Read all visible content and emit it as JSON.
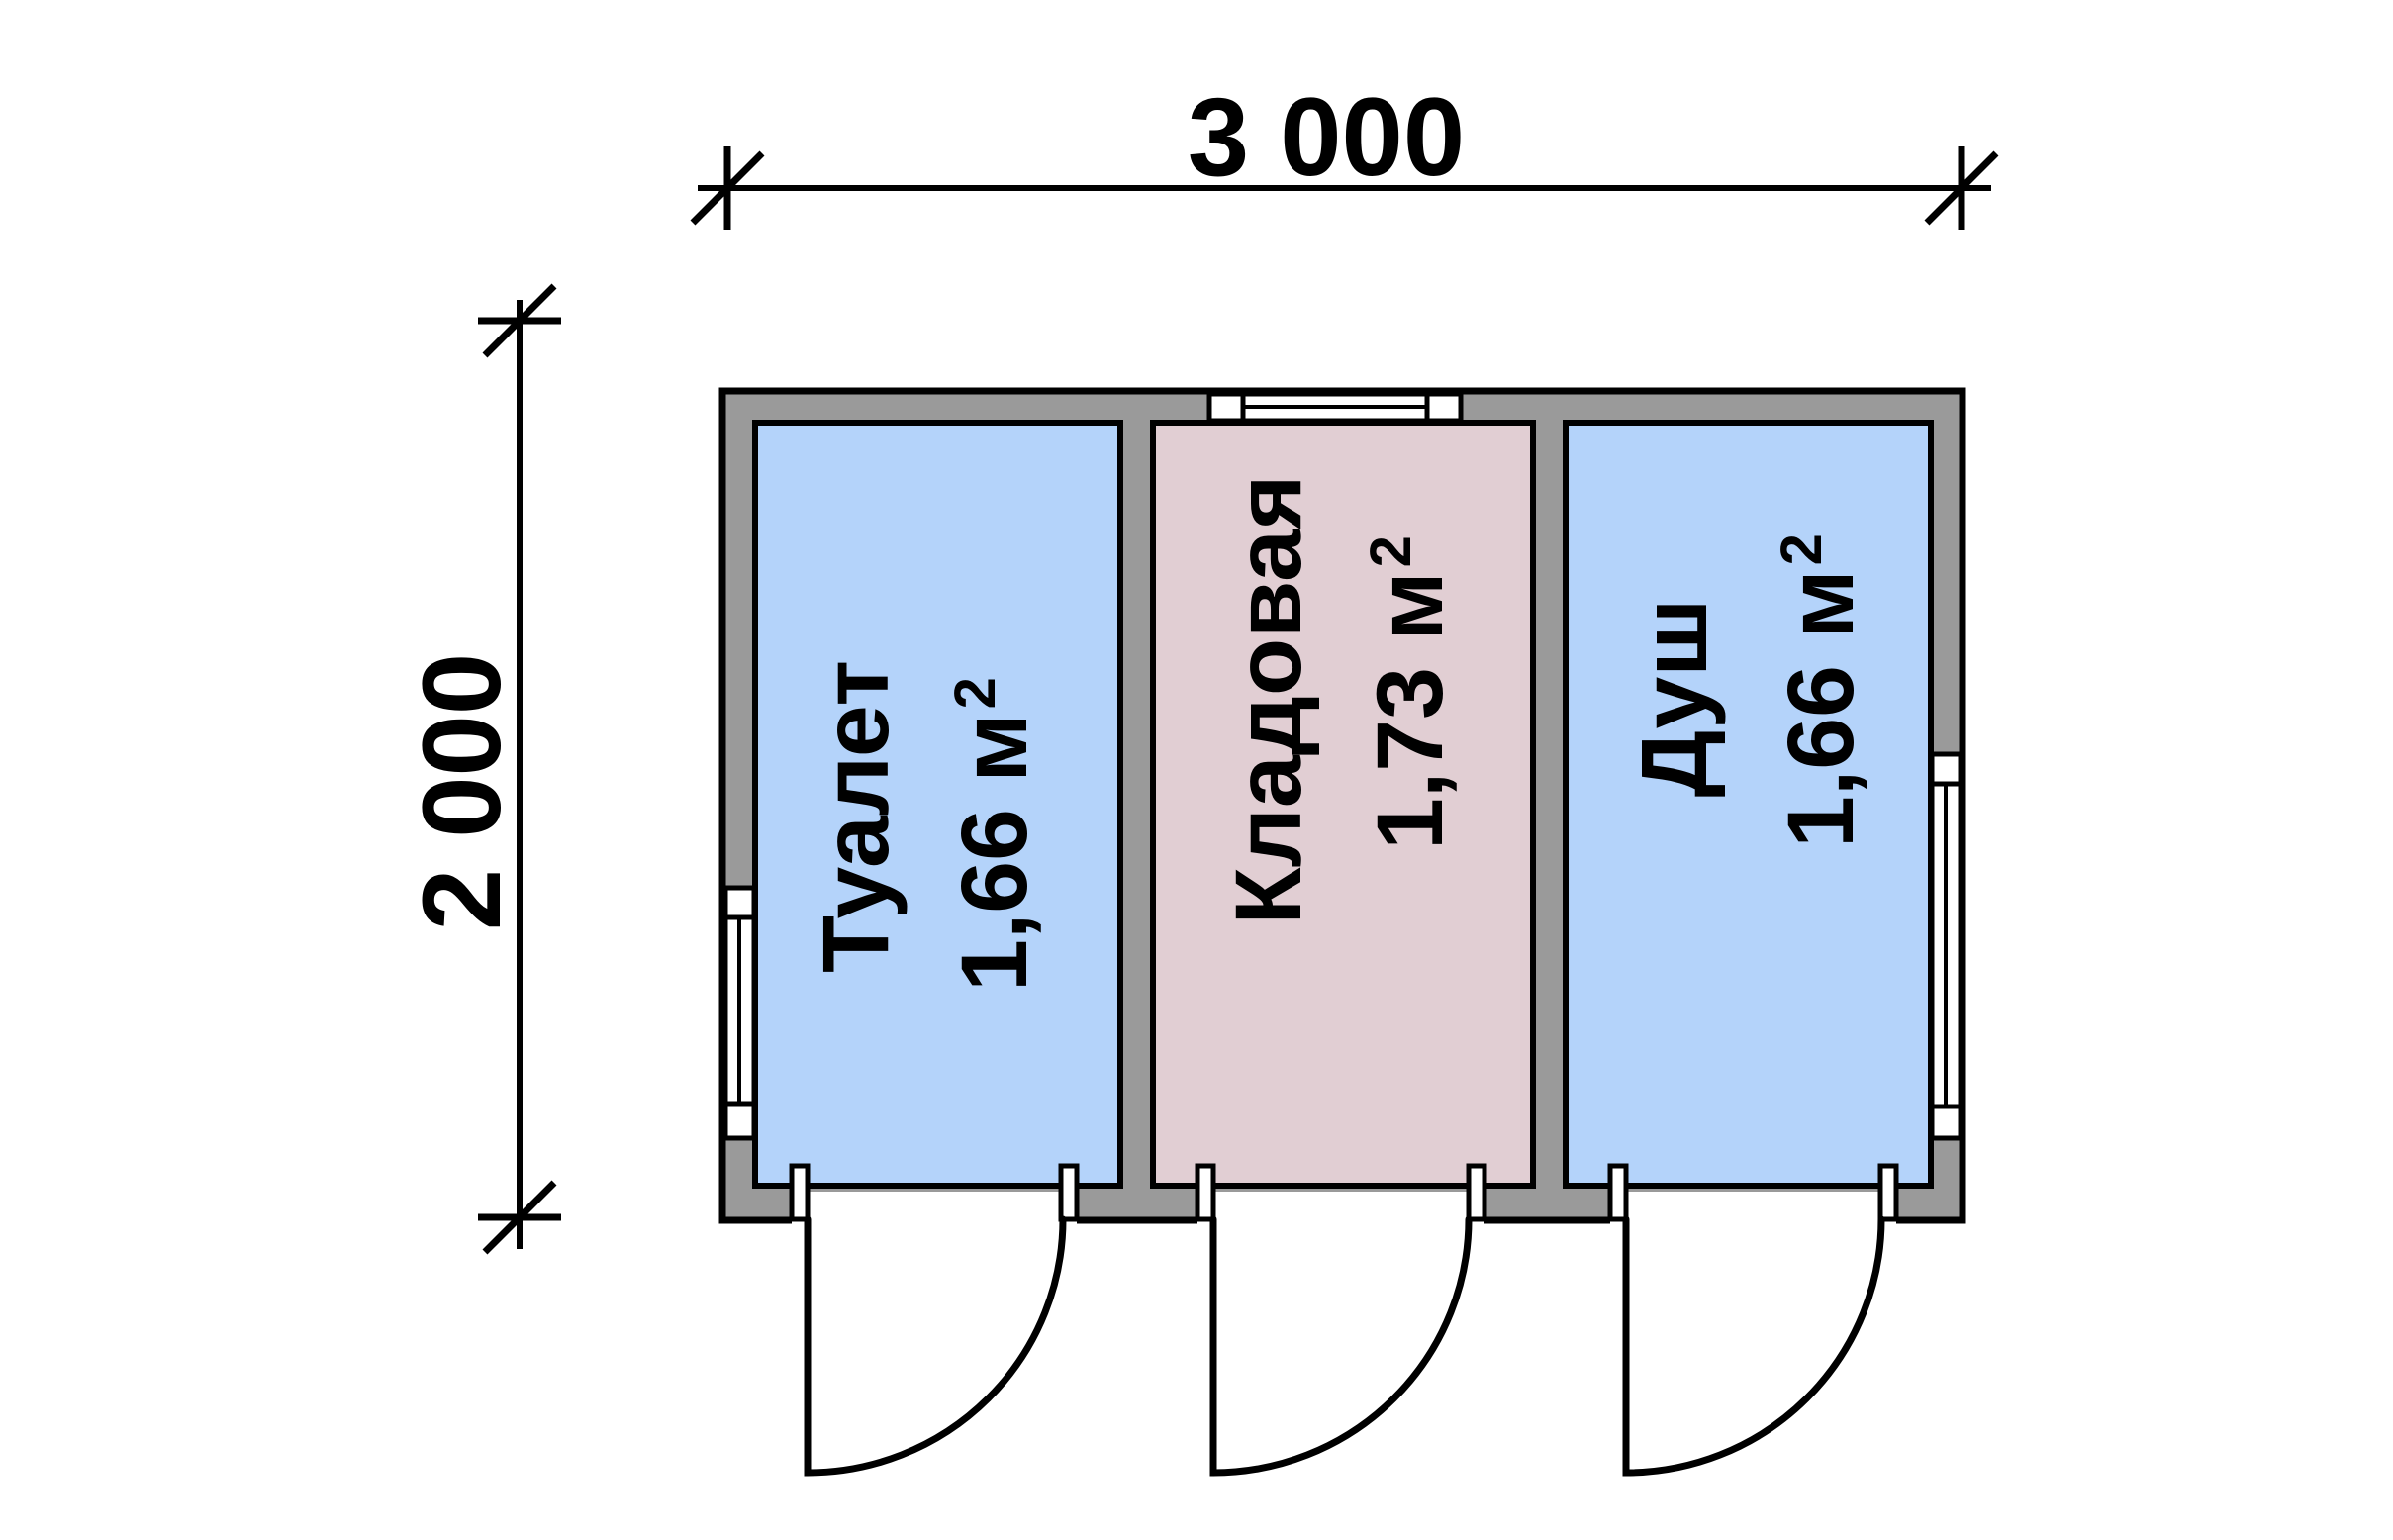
{
  "dimensions": {
    "width_label": "3 000",
    "height_label": "2 000"
  },
  "rooms": [
    {
      "name": "Туалет",
      "area_main": "1,66 м",
      "area_sup": "2",
      "fill": "#b4d3fa"
    },
    {
      "name": "Кладовая",
      "area_main": "1,73 м",
      "area_sup": "2",
      "fill": "#e1ced3"
    },
    {
      "name": "Душ",
      "area_main": "1,66 м",
      "area_sup": "2",
      "fill": "#b4d3fa"
    }
  ],
  "colors": {
    "wall": "#9a9a9a",
    "outline": "#000000",
    "window": "#ffffff",
    "background": "#ffffff"
  }
}
